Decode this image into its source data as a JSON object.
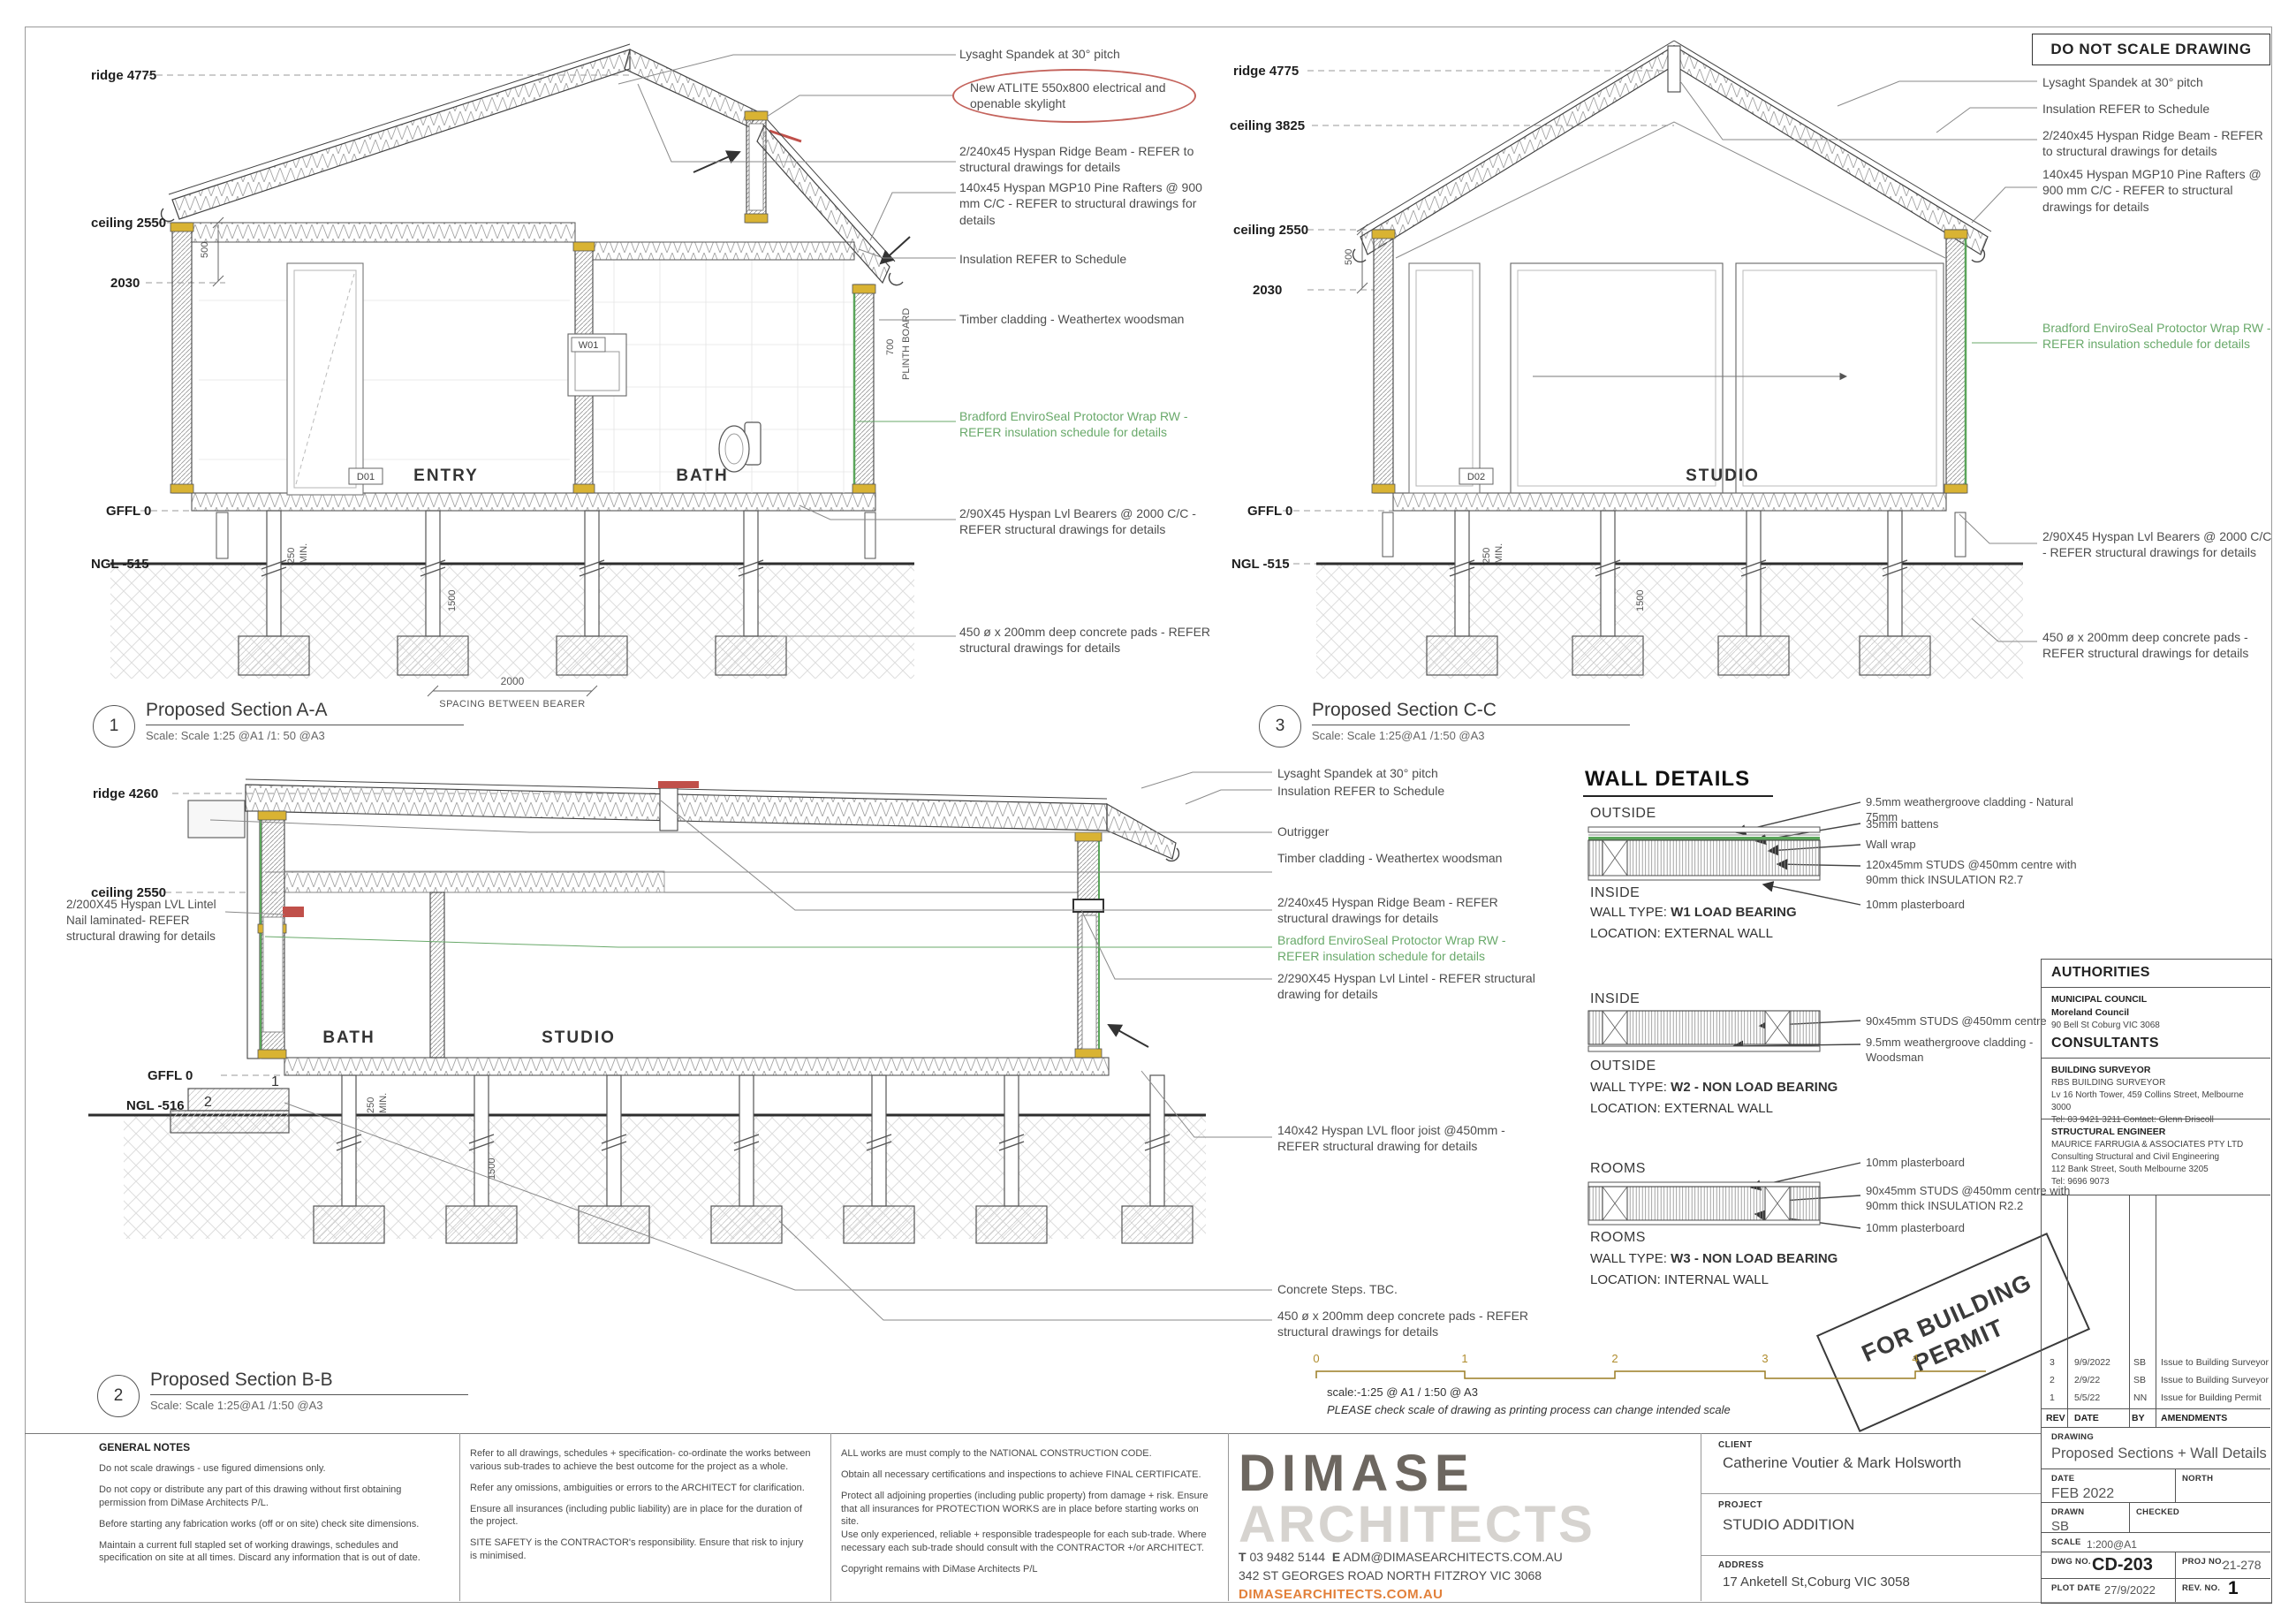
{
  "colors": {
    "green_note": "#69a96a",
    "red_mark": "#c0504a",
    "orange_brand": "#e2803a",
    "logo_dark": "#6d6760",
    "logo_light": "#d6d3cf",
    "scalebar_num": "#b08d2e",
    "yellow_block": "#d9b333"
  },
  "header": {
    "do_not_scale": "DO NOT SCALE DRAWING"
  },
  "stamp": {
    "line1": "FOR BUILDING",
    "line2": "PERMIT"
  },
  "scalebar": {
    "ticks": [
      "0",
      "1",
      "2",
      "3",
      "4"
    ],
    "scale_text": "scale:-1:25 @ A1 / 1:50 @ A3",
    "warning": "PLEASE check scale of drawing as printing process can change intended scale"
  },
  "section_a": {
    "num": "1",
    "title": "Proposed Section A-A",
    "scale": "Scale: Scale 1:25 @A1 /1: 50 @A3",
    "levels": {
      "ridge": "ridge 4775",
      "ceiling": "ceiling 2550",
      "d500": "500",
      "l2030": "2030",
      "gffl": "GFFL 0",
      "ngl": "NGL -515"
    },
    "rooms": {
      "entry": "ENTRY",
      "bath": "BATH",
      "door": "D01",
      "window": "W01"
    },
    "dims": {
      "d250": "250",
      "min": "MIN.",
      "d1500": "1500",
      "d700": "700",
      "plinth": "PLINTH BOARD",
      "spacing": "2000",
      "spacing_label": "SPACING BETWEEN BEARER"
    },
    "callouts": [
      {
        "text": "Lysaght Spandek at 30° pitch"
      },
      {
        "text": "New ATLITE 550x800 electrical and openable skylight"
      },
      {
        "text": "2/240x45 Hyspan Ridge Beam - REFER to structural drawings for details"
      },
      {
        "text": "140x45 Hyspan MGP10 Pine Rafters @ 900 mm C/C - REFER to structural drawings for details"
      },
      {
        "text": "Insulation REFER to Schedule"
      },
      {
        "text": "Timber cladding - Weathertex woodsman"
      },
      {
        "text": "Bradford EnviroSeal Protoctor Wrap RW - REFER insulation schedule for details"
      },
      {
        "text": "2/90X45 Hyspan Lvl Bearers @ 2000 C/C - REFER structural drawings for details"
      },
      {
        "text": "450 ø x 200mm deep concrete pads - REFER structural drawings for details"
      }
    ]
  },
  "section_c": {
    "num": "3",
    "title": "Proposed Section C-C",
    "scale": "Scale: Scale 1:25@A1 /1:50 @A3",
    "levels": {
      "ridge": "ridge 4775",
      "ceiling_u": "ceiling 3825",
      "ceiling": "ceiling 2550",
      "d500": "500",
      "l2030": "2030",
      "gffl": "GFFL 0",
      "ngl": "NGL -515"
    },
    "rooms": {
      "studio": "STUDIO",
      "door": "D02"
    },
    "dims": {
      "d250": "250",
      "min": "MIN.",
      "d1500": "1500"
    },
    "callouts": [
      {
        "text": "Lysaght Spandek at 30° pitch"
      },
      {
        "text": "Insulation REFER to Schedule"
      },
      {
        "text": "2/240x45 Hyspan Ridge Beam - REFER to structural drawings for details"
      },
      {
        "text": "140x45 Hyspan MGP10 Pine Rafters @ 900 mm C/C - REFER to structural drawings for details"
      },
      {
        "text": "Bradford EnviroSeal Protoctor Wrap RW - REFER insulation schedule for details"
      },
      {
        "text": "2/90X45 Hyspan Lvl Bearers @ 2000 C/C - REFER structural drawings for details"
      },
      {
        "text": "450 ø x 200mm deep concrete pads - REFER structural drawings for details"
      }
    ]
  },
  "section_b": {
    "num": "2",
    "title": "Proposed Section B-B",
    "scale": "Scale: Scale 1:25@A1 /1:50 @A3",
    "levels": {
      "ridge": "ridge 4260",
      "ceiling": "ceiling 2550",
      "gffl": "GFFL 0",
      "ngl": "NGL -516"
    },
    "left_callout": "2/200X45 Hyspan LVL Lintel Nail laminated- REFER structural drawing for details",
    "rooms": {
      "bath": "BATH",
      "studio": "STUDIO"
    },
    "dims": {
      "d250": "250",
      "min": "MIN.",
      "d1500": "1500",
      "step1": "1",
      "step2": "2"
    },
    "callouts": [
      {
        "text": "Lysaght Spandek at 30° pitch"
      },
      {
        "text": "Insulation REFER to Schedule"
      },
      {
        "text": "Outrigger"
      },
      {
        "text": "Timber cladding - Weathertex woodsman"
      },
      {
        "text": "2/240x45 Hyspan Ridge Beam - REFER structural drawings for details"
      },
      {
        "text": "Bradford EnviroSeal Protoctor Wrap RW - REFER insulation schedule for details"
      },
      {
        "text": "2/290X45 Hyspan Lvl Lintel - REFER structural drawing for details"
      },
      {
        "text": "140x42 Hyspan LVL floor joist @450mm - REFER structural drawing for details"
      },
      {
        "text": "Concrete Steps. TBC."
      },
      {
        "text": "450 ø x 200mm deep concrete pads - REFER structural drawings for details"
      }
    ]
  },
  "wall_details": {
    "title": "WALL DETAILS",
    "w1": {
      "side_top": "OUTSIDE",
      "side_bottom": "INSIDE",
      "type_label": "WALL TYPE: ",
      "type_value": "W1 LOAD BEARING",
      "location": "LOCATION: EXTERNAL WALL",
      "callouts": [
        "9.5mm weathergroove cladding - Natural 75mm",
        "35mm battens",
        "Wall wrap",
        "120x45mm STUDS @450mm centre with 90mm thick INSULATION R2.7",
        "10mm plasterboard"
      ]
    },
    "w2": {
      "side_top": "INSIDE",
      "side_bottom": "OUTSIDE",
      "type_label": "WALL TYPE: ",
      "type_value": "W2 - NON LOAD BEARING",
      "location": "LOCATION: EXTERNAL WALL",
      "callouts": [
        "90x45mm STUDS @450mm centre",
        "9.5mm weathergroove cladding - Woodsman"
      ]
    },
    "w3": {
      "side_top": "ROOMS",
      "side_bottom": "ROOMS",
      "type_label": "WALL TYPE: ",
      "type_value": "W3 - NON LOAD BEARING",
      "location": "LOCATION: INTERNAL WALL",
      "callouts": [
        "10mm plasterboard",
        "90x45mm STUDS @450mm centre with 90mm thick INSULATION R2.2",
        "10mm plasterboard"
      ]
    }
  },
  "sidebar": {
    "authorities_title": "AUTHORITIES",
    "municipal": {
      "label": "MUNICIPAL COUNCIL",
      "name": "Moreland Council",
      "addr": "90 Bell St Coburg VIC 3068"
    },
    "consultants_title": "CONSULTANTS",
    "surveyor": {
      "label": "BUILDING SURVEYOR",
      "name": "RBS BUILDING SURVEYOR",
      "addr": "Lv 16 North Tower, 459 Collins Street, Melbourne 3000",
      "tel": "Tel: 03 9421 3211 Contact: Glenn Driscoll"
    },
    "engineer": {
      "label": "STRUCTURAL ENGINEER",
      "name": "MAURICE FARRUGIA & ASSOCIATES PTY LTD",
      "line2": "Consulting Structural and Civil Engineering",
      "addr": "112 Bank Street, South Melbourne 3205",
      "tel": "Tel: 9696 9073"
    },
    "revisions": [
      {
        "rev": "3",
        "date": "9/9/2022",
        "by": "SB",
        "amendment": "Issue to Building Surveyor"
      },
      {
        "rev": "2",
        "date": "2/9/22",
        "by": "SB",
        "amendment": "Issue to Building Surveyor"
      },
      {
        "rev": "1",
        "date": "5/5/22",
        "by": "NN",
        "amendment": "Issue for Building Permit"
      }
    ],
    "rev_header": {
      "rev": "REV",
      "date": "DATE",
      "by": "BY",
      "amendments": "AMENDMENTS"
    },
    "titleblock": {
      "drawing_label": "DRAWING",
      "drawing": "Proposed Sections + Wall Details",
      "date_label": "DATE",
      "date": "FEB 2022",
      "north_label": "NORTH",
      "drawn_label": "DRAWN",
      "drawn": "SB",
      "checked_label": "CHECKED",
      "scale_label": "SCALE",
      "scale": "1:200@A1",
      "dwg_label": "DWG NO.",
      "dwg": "CD-203",
      "proj_label": "PROJ NO.",
      "proj": "21-278",
      "plot_label": "PLOT DATE",
      "plot": "27/9/2022",
      "rev_label": "REV. NO.",
      "rev": "1"
    }
  },
  "project": {
    "client_label": "CLIENT",
    "client": "Catherine Voutier & Mark Holsworth",
    "project_label": "PROJECT",
    "project": "STUDIO ADDITION",
    "address_label": "ADDRESS",
    "address": "17 Anketell St,Coburg VIC 3058"
  },
  "notes": {
    "title": "GENERAL NOTES",
    "col1": [
      "Do not scale drawings - use figured dimensions only.",
      "Do not copy or distribute any part of this drawing without first obtaining permission from DiMase Architects P/L.",
      "Before starting any fabrication works (off or on site) check site dimensions.",
      "Maintain a current full stapled set of working drawings, schedules and specification on site at all times. Discard any information that is out of date."
    ],
    "col2": [
      "Refer to all drawings, schedules + specification- co-ordinate the works between various sub-trades to achieve the best outcome for the project as a whole.",
      "Refer any omissions, ambiguities or errors to the ARCHITECT for clarification.",
      "Ensure all insurances (including public liability) are in place for the duration of the project.",
      "SITE SAFETY is the CONTRACTOR's responsibility. Ensure that risk to injury is minimised."
    ],
    "col3": [
      "ALL works are must comply to the NATIONAL CONSTRUCTION CODE.",
      "Obtain all necessary certifications and inspections to achieve FINAL CERTIFICATE.",
      "Protect all adjoining properties (including public property) from damage + risk. Ensure that all insurances for PROTECTION WORKS are in place before starting works on site.",
      "Use only experienced, reliable + responsible tradespeople for each sub-trade. Where necessary each sub-trade should consult with the CONTRACTOR +/or ARCHITECT.",
      "Copyright remains with DiMase Architects P/L"
    ]
  },
  "brand": {
    "name_top": "DIMASE",
    "name_bottom": "ARCHITECTS",
    "tel_label": "T",
    "tel": "03 9482 5144",
    "email_label": "E",
    "email": "ADM@DIMASEARCHITECTS.COM.AU",
    "street": "342 ST GEORGES ROAD NORTH FITZROY VIC 3068",
    "web": "DIMASEARCHITECTS.COM.AU"
  }
}
